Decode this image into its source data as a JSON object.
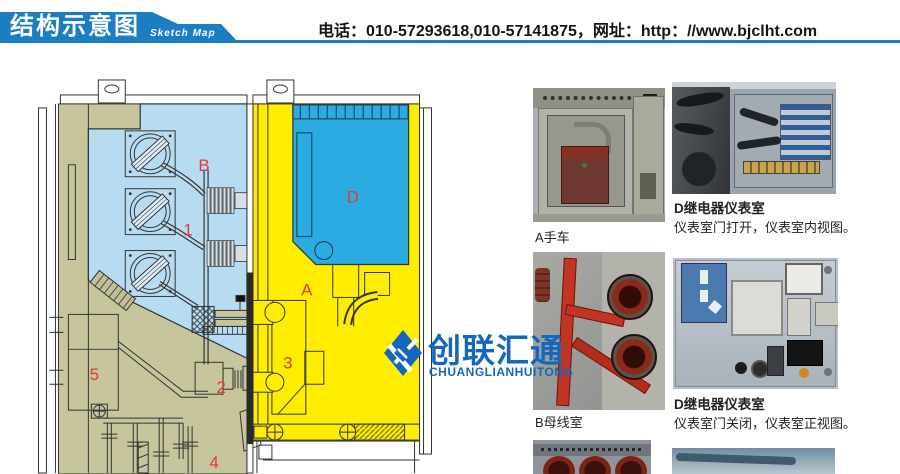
{
  "header": {
    "title": "结构示意图",
    "subtitle": "Sketch Map",
    "contact": "电话：010-57293618,010-57141875，网址：http：//www.bjclht.com"
  },
  "diagram": {
    "labels": [
      {
        "text": "B"
      },
      {
        "text": "1"
      },
      {
        "text": "D"
      },
      {
        "text": "A"
      },
      {
        "text": "3"
      },
      {
        "text": "5"
      },
      {
        "text": "2"
      },
      {
        "text": "4"
      }
    ],
    "colors": {
      "busbar_room_blue": "#b7dcf2",
      "relay_room_blue": "#2aabe2",
      "breaker_room_yellow": "#ffed00",
      "cable_room_olive": "#c6c59c",
      "label_red": "#e8392f"
    }
  },
  "logo": {
    "cn": "创联汇通",
    "en": "CHUANGLIANHUITONG",
    "color": "#1566bd"
  },
  "photos": {
    "a": {
      "caption": "A手车"
    },
    "d_open": {
      "title": "D继电器仪表室",
      "caption": "仪表室门打开，仪表室内视图。"
    },
    "b": {
      "caption": "B母线室"
    },
    "d_closed": {
      "title": "D继电器仪表室",
      "caption": "仪表室门关闭，仪表室正视图。"
    }
  },
  "colors": {
    "header_blue": "#1b7ec2"
  }
}
